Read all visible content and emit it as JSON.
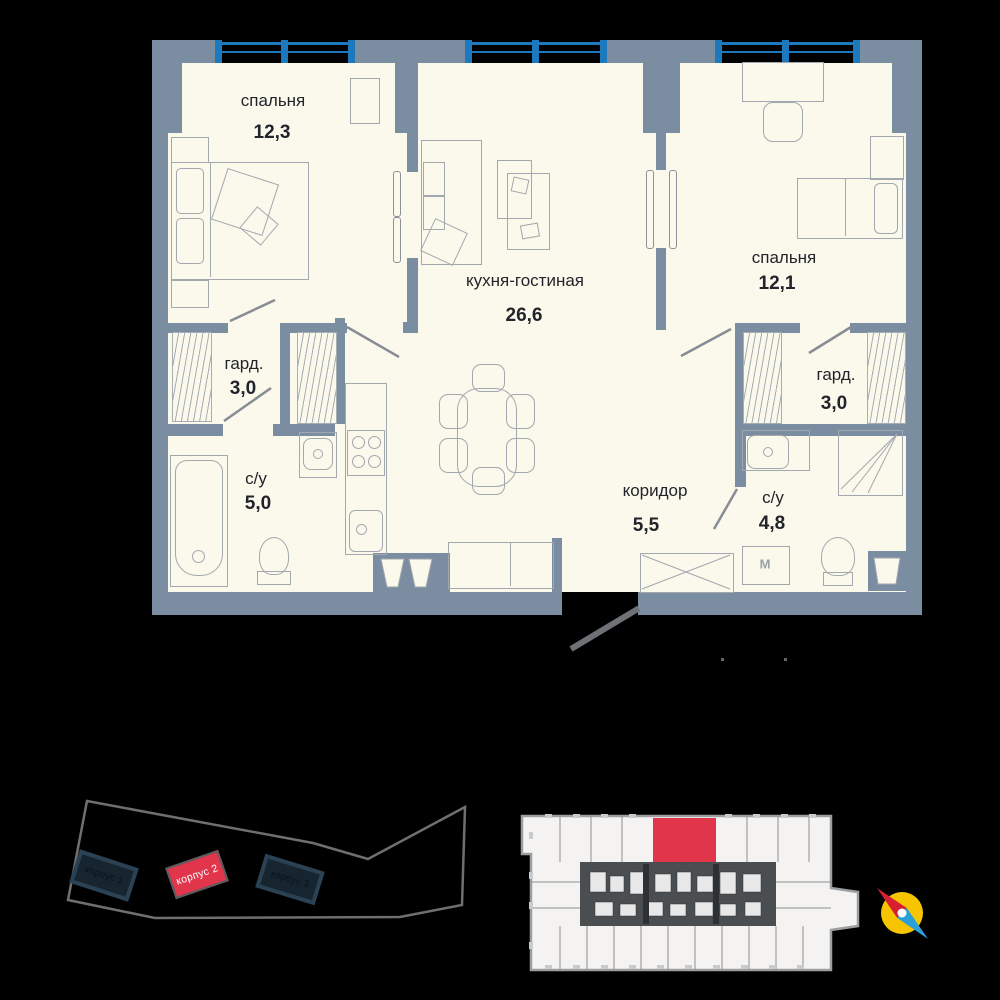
{
  "floorplan": {
    "rooms": {
      "bedroom1": {
        "name": "спальня",
        "area": "12,3"
      },
      "living": {
        "name": "кухня-гостиная",
        "area": "26,6"
      },
      "bedroom2": {
        "name": "спальня",
        "area": "12,1"
      },
      "wardrobe_left": {
        "name": "гард.",
        "area": "3,0"
      },
      "bath_left": {
        "name": "с/у",
        "area": "5,0"
      },
      "corridor": {
        "name": "коридор",
        "area": "5,5"
      },
      "bath_right": {
        "name": "с/у",
        "area": "4,8"
      },
      "wardrobe_right": {
        "name": "гард.",
        "area": "3,0"
      }
    },
    "appliances": {
      "washing_machine": "M"
    }
  },
  "site_plan": {
    "buildings": [
      {
        "label": "корпус 1",
        "highlighted": false
      },
      {
        "label": "корпус 2",
        "highlighted": true
      },
      {
        "label": "корпус 3",
        "highlighted": false
      }
    ]
  },
  "colors": {
    "wall": "#7b8da0",
    "floor": "#fbf8ec",
    "window_blue": "#1d79bd",
    "highlight_red": "#e0354b",
    "building_dark": "#16252f",
    "outline_gray": "#6f6f6f",
    "compass_yellow": "#f6c500"
  }
}
